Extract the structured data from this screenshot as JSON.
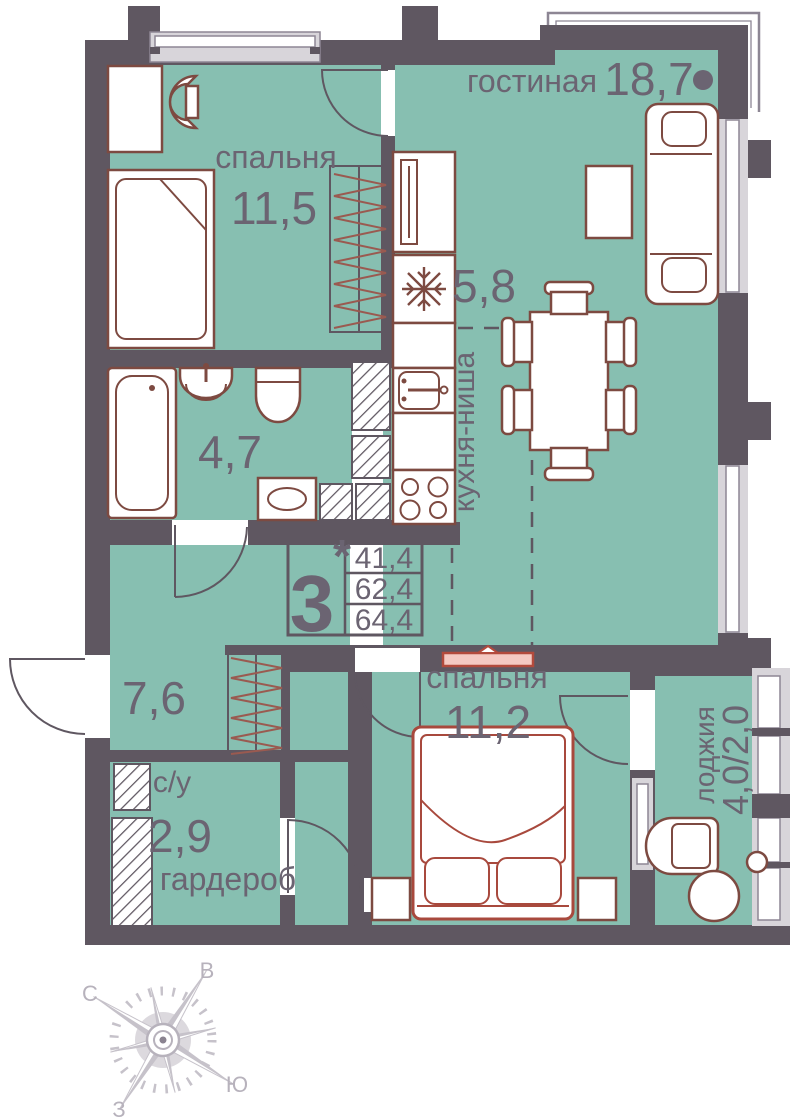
{
  "plan_title": "floor-plan",
  "rooms": {
    "living": {
      "label": "гостиная",
      "area": "18,7"
    },
    "bedroom_top": {
      "label": "спальня",
      "area": "11,5"
    },
    "kitchen": {
      "label": "кухня-ниша",
      "area": "5,8"
    },
    "bathroom": {
      "area": "4,7"
    },
    "hallway": {
      "area": "7,6"
    },
    "bedroom_bottom": {
      "label": "спальня",
      "area": "11,2"
    },
    "su": {
      "label": "с/у",
      "area": "2,9"
    },
    "wardrobe": {
      "label": "гардероб"
    },
    "loggia": {
      "label": "лоджия",
      "area": "4,0/2,0"
    }
  },
  "summary": {
    "rooms": "3",
    "star": "*",
    "living_area": "41,4",
    "area": "62,4",
    "total_area": "64,4"
  },
  "compass": {
    "n": "С",
    "e": "В",
    "s": "Ю",
    "w": "З"
  },
  "colors": {
    "room_fill": "#87bfb1",
    "wall": "#5f5761",
    "furniture_outline": "#7d4a41",
    "accent_red": "#a8493d",
    "label_text": "#6b6472",
    "glazing": "#d8d5da",
    "frame": "#8d8694",
    "compass": "#c6c2ca"
  }
}
